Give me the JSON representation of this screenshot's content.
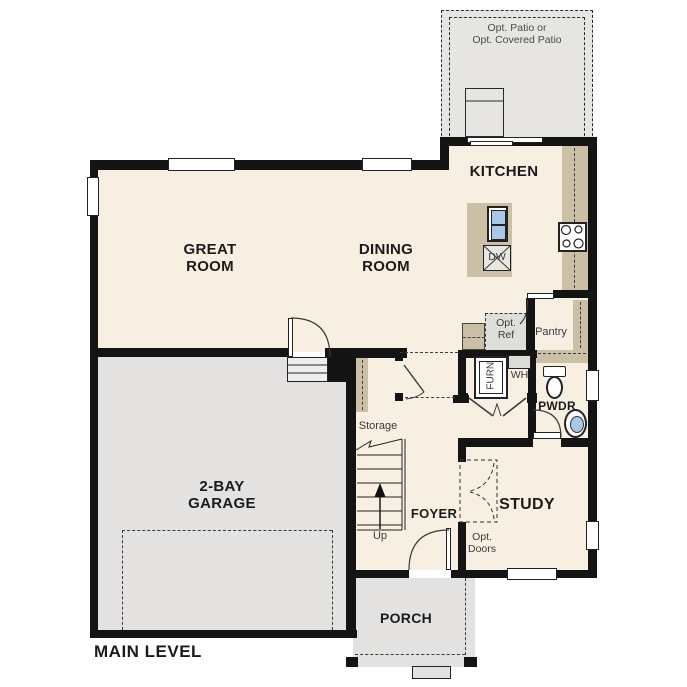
{
  "plan_title": "MAIN LEVEL",
  "rooms": {
    "patio": {
      "label_line1": "Opt. Patio or",
      "label_line2": "Opt. Covered Patio"
    },
    "kitchen": {
      "label": "KITCHEN"
    },
    "great_room": {
      "label_line1": "GREAT",
      "label_line2": "ROOM"
    },
    "dining_room": {
      "label_line1": "DINING",
      "label_line2": "ROOM"
    },
    "garage": {
      "label_line1": "2-BAY",
      "label_line2": "GARAGE"
    },
    "pantry": {
      "label": "Pantry"
    },
    "powder": {
      "label": "PWDR"
    },
    "storage": {
      "label": "Storage"
    },
    "foyer": {
      "label": "FOYER"
    },
    "study": {
      "label": "STUDY"
    },
    "porch": {
      "label": "PORCH"
    }
  },
  "fixtures": {
    "dishwasher": {
      "label": "DW"
    },
    "opt_ref": {
      "label_line1": "Opt.",
      "label_line2": "Ref"
    },
    "furnace": {
      "label": "FURN"
    },
    "water_heater": {
      "label": "WH"
    },
    "stairs": {
      "label": "Up"
    },
    "opt_doors": {
      "label_line1": "Opt.",
      "label_line2": "Doors"
    }
  },
  "colors": {
    "floor_cream": "#f7efe2",
    "garage_gray": "#e3e2e0",
    "patio_gray": "#e6e5e2",
    "cabinet_tan": "#cbbfa6",
    "wall_black": "#141414",
    "fixture_blue": "#a9c8e6"
  }
}
